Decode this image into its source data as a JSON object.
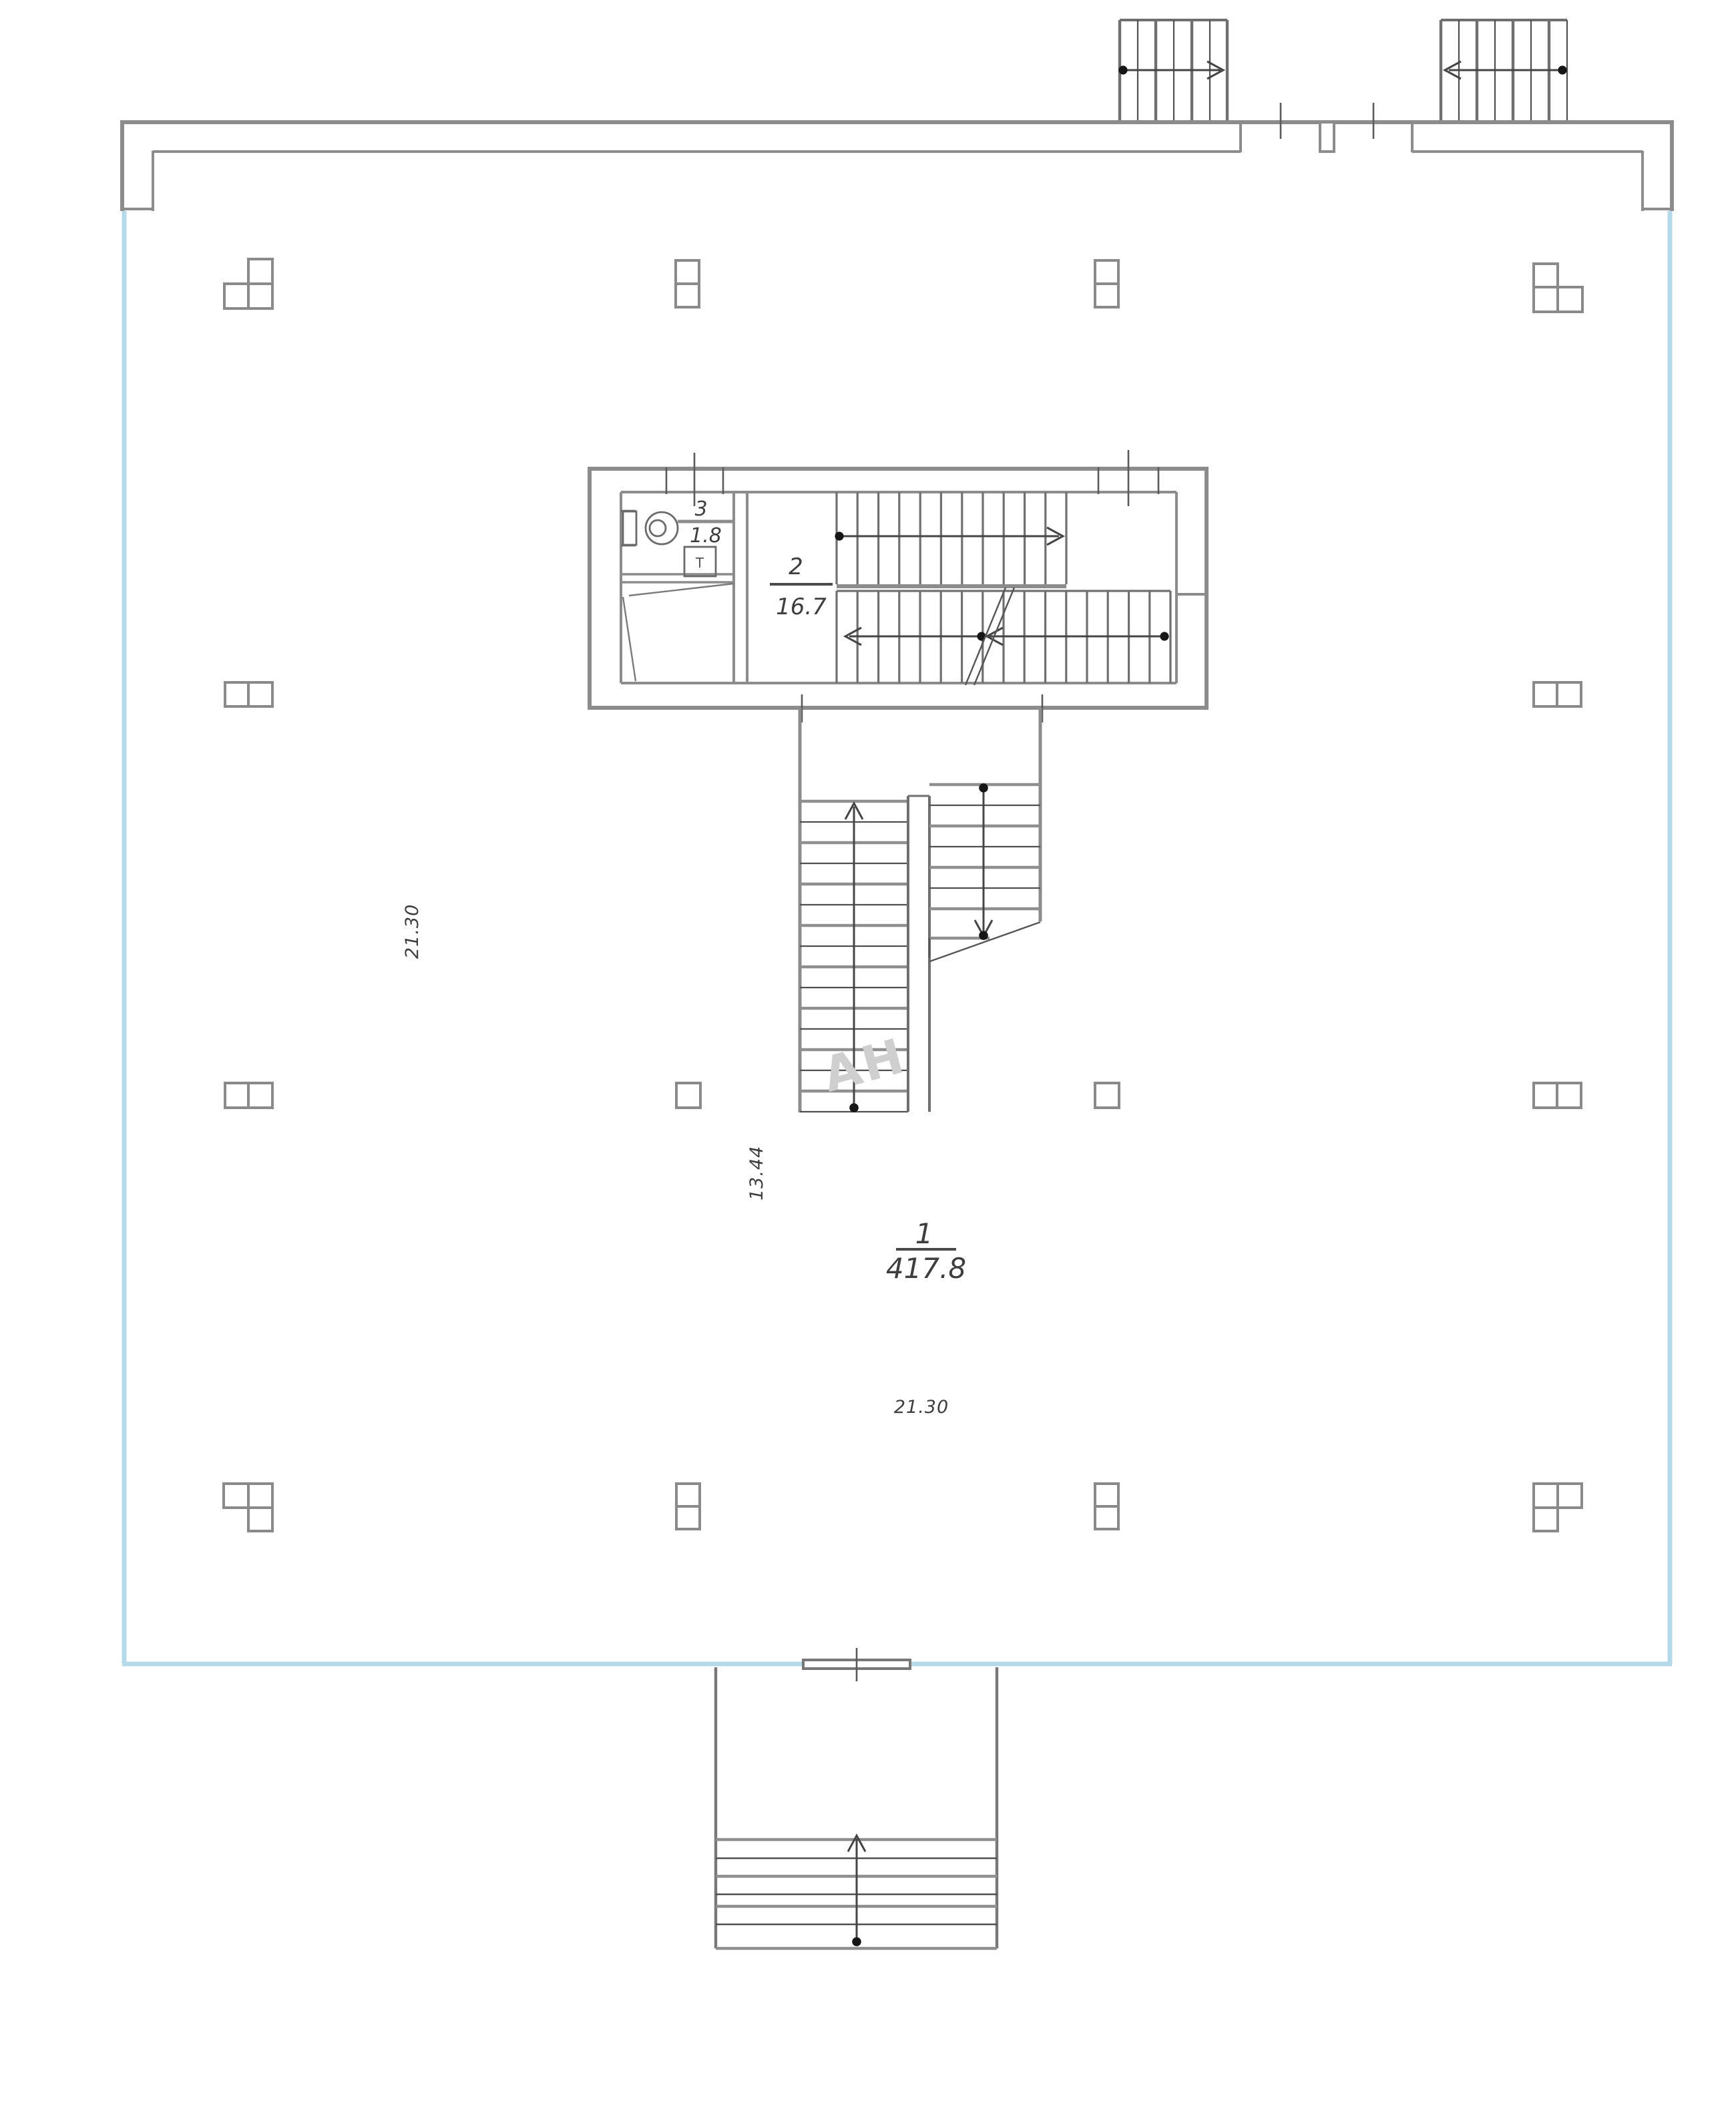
{
  "plan": {
    "rooms": [
      {
        "number": "1",
        "area": "417.8"
      },
      {
        "number": "2",
        "area": "16.7"
      },
      {
        "number": "3",
        "area": "1.8"
      }
    ],
    "dimensions": {
      "left_vertical": "21.30",
      "stair_vertical": "13.44",
      "bottom_horizontal": "21.30"
    },
    "labels": {
      "equipment": "T"
    },
    "watermark": "АН",
    "colors": {
      "wall_gray": "#8c8c8c",
      "accent_blue": "#b5d9e9",
      "text": "#3e3e3e",
      "watermark_gray": "#cfcfcf"
    }
  }
}
